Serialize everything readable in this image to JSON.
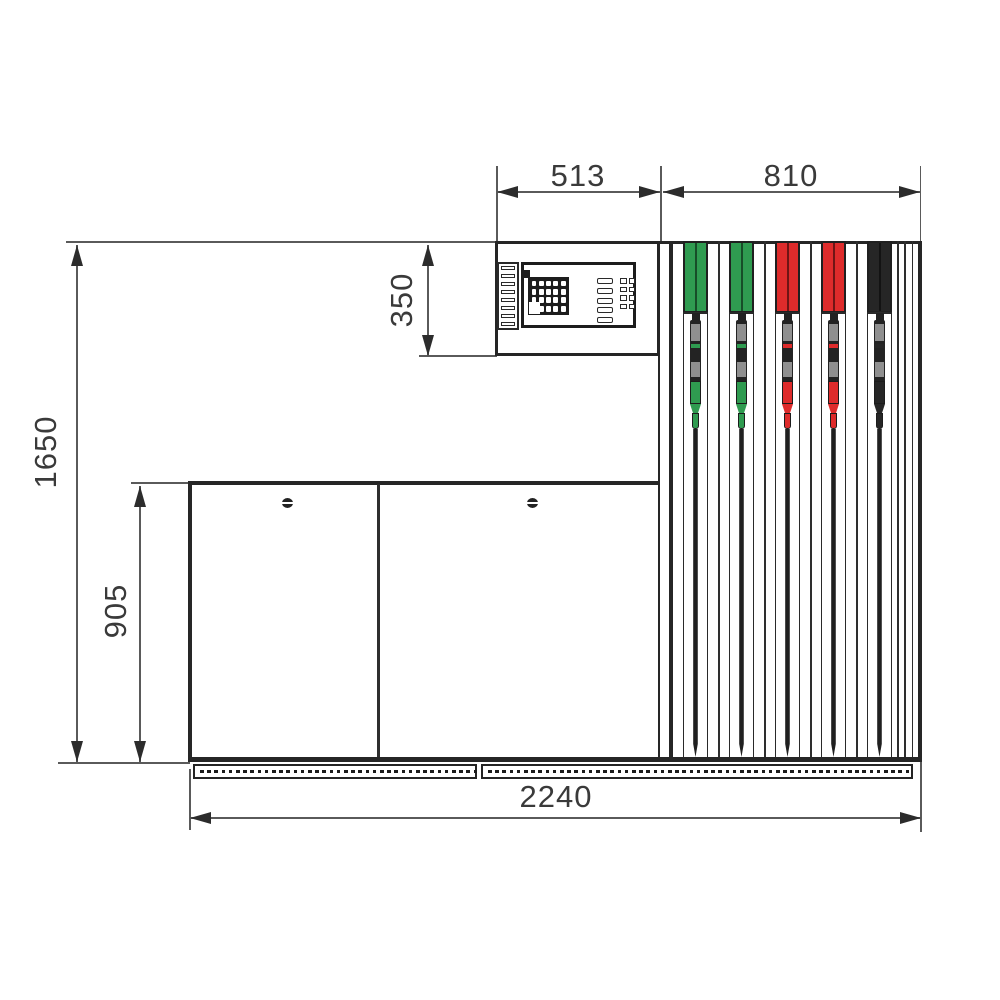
{
  "diagram": {
    "type": "technical-drawing",
    "subject": "fuel-dispenser-front-elevation",
    "labels": {
      "head_width": "513",
      "hose_section_width": "810",
      "head_height": "350",
      "overall_height": "1650",
      "cabinet_height": "905",
      "overall_width": "2240"
    },
    "dimensions": [
      {
        "id": "head_width",
        "value": 513,
        "unit": "mm",
        "orientation": "horizontal"
      },
      {
        "id": "hose_section_width",
        "value": 810,
        "unit": "mm",
        "orientation": "horizontal"
      },
      {
        "id": "head_height",
        "value": 350,
        "unit": "mm",
        "orientation": "vertical"
      },
      {
        "id": "overall_height",
        "value": 1650,
        "unit": "mm",
        "orientation": "vertical"
      },
      {
        "id": "cabinet_height",
        "value": 905,
        "unit": "mm",
        "orientation": "vertical"
      },
      {
        "id": "overall_width",
        "value": 2240,
        "unit": "mm",
        "orientation": "horizontal"
      }
    ],
    "stations": [
      {
        "name": "nozzle-station-green-1",
        "color": "#2F9B50"
      },
      {
        "name": "nozzle-station-green-2",
        "color": "#2F9B50"
      },
      {
        "name": "nozzle-station-red-1",
        "color": "#DE2B2B"
      },
      {
        "name": "nozzle-station-red-2",
        "color": "#DE2B2B"
      },
      {
        "name": "nozzle-station-black",
        "color": "#262626"
      }
    ],
    "colors": {
      "outline": "#262626",
      "dimension_line": "#5a5a5a",
      "text": "#3a3a3a",
      "grey_detail": "#8f8f8f",
      "background": "#ffffff"
    }
  }
}
